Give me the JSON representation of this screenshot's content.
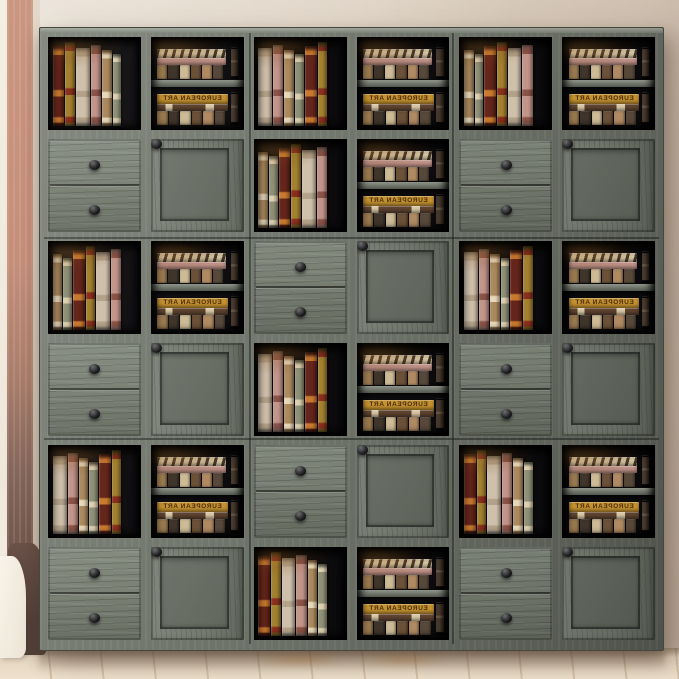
{
  "scene": {
    "description": "Product photo: 6x6 modular farmhouse storage bookcase wall unit in weathered gray oak, styled with vintage books, against a beige wall with salmon corner beam, green plant sprigs, white curtain and light wood floor",
    "wall_color": "#ddd1c2",
    "wall_highlight": "#e7ddd0",
    "wall_shadow": "#bfae9d",
    "beam_top_color": "#cb967f",
    "beam_bottom_color": "#5f463d",
    "floor_color": "#e6d7c2",
    "curtain_color": "#f8f3e9",
    "curtain_shadow_color": "#5e483e",
    "plant_leaf_colors": [
      "#6e8c3e",
      "#93ad5f",
      "#a9bd74",
      "#5f7d35"
    ]
  },
  "cabinet": {
    "rows": 6,
    "cols": 6,
    "frame_color": "#6f746a",
    "frame_top_edge_color": "#a2a89b",
    "face_color": "#767c70",
    "interior_color": "#0c0b0d",
    "interior_glow_color": "rgba(214,142,52,0.42)",
    "knob_color": "#232326",
    "cell_types": {
      "O": "open-cube-with-books",
      "T": "two-tier-shelf-cube",
      "D": "two-drawer-cube",
      "X": "barn-door-cube"
    },
    "grid": [
      [
        "O",
        "T",
        "O",
        "T",
        "O",
        "T"
      ],
      [
        "D",
        "X",
        "O",
        "T",
        "D",
        "X"
      ],
      [
        "O",
        "T",
        "D",
        "X",
        "O",
        "T"
      ],
      [
        "D",
        "X",
        "O",
        "T",
        "D",
        "X"
      ],
      [
        "O",
        "T",
        "D",
        "X",
        "O",
        "T"
      ],
      [
        "D",
        "X",
        "O",
        "T",
        "D",
        "X"
      ]
    ]
  },
  "books": {
    "label_text": "EUROPEAN ART",
    "label_is_mirrored": true,
    "tall_spines": [
      {
        "c": "#64251a",
        "a": "#c9792f",
        "w": 16,
        "h": 93
      },
      {
        "c": "#a3812f",
        "a": "#8a2f1d",
        "w": 13,
        "h": 98
      },
      {
        "c": "#cfc0ab",
        "a": "#b3a28a",
        "w": 19,
        "h": 90
      },
      {
        "c": "#c2948a",
        "a": "#8a5347",
        "w": 14,
        "h": 94
      },
      {
        "c": "#ab8a5f",
        "a": "#e8d8b8",
        "w": 13,
        "h": 88
      },
      {
        "c": "#8f9077",
        "a": "#ddd0b0",
        "w": 12,
        "h": 84
      }
    ],
    "tier_top_horizontals": [
      {
        "c": "#d9c9a6",
        "chevron": true,
        "chevron_dark": "#483a2c",
        "h": 24
      },
      {
        "c": "#c2948a",
        "h": 21
      }
    ],
    "tier_bottom_horizontals": [
      {
        "c": "#c5922f",
        "labeled": true,
        "h": 27
      },
      {
        "c": "#5f4430",
        "patched": true,
        "patch_color": "#d9c9a6",
        "h": 20
      }
    ],
    "tier_mini_spines": [
      {
        "c": "#9a7a4f",
        "h": 100
      },
      {
        "c": "#3f352b",
        "h": 88
      },
      {
        "c": "#cdbb96",
        "h": 96
      },
      {
        "c": "#6b5138",
        "h": 80
      },
      {
        "c": "#b08a62",
        "h": 92
      },
      {
        "c": "#57483a",
        "h": 86
      }
    ],
    "tier_vertical_book_color": "#4a3c30"
  }
}
